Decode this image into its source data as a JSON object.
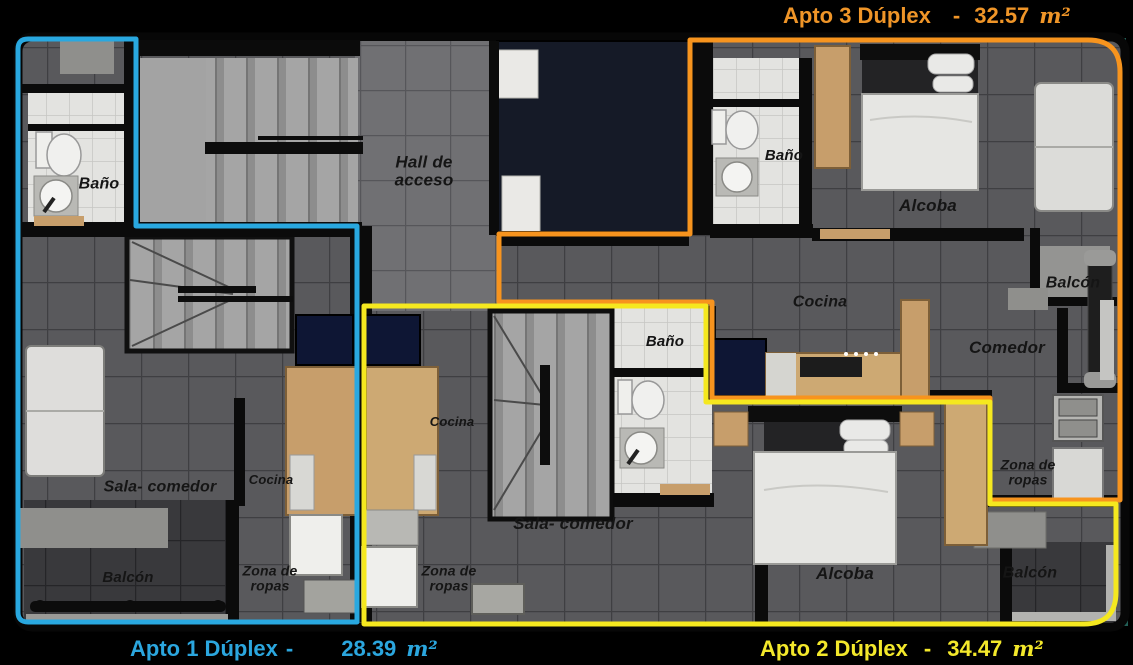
{
  "legend": {
    "apto1": {
      "name": "Apto 1 Dúplex",
      "dash": "-",
      "area": "28.39",
      "unit": "m²"
    },
    "apto2": {
      "name": "Apto 2 Dúplex",
      "dash": "-",
      "area": "34.47",
      "unit": "m²"
    },
    "apto3": {
      "name": "Apto 3 Dúplex",
      "dash": "-",
      "area": "32.57",
      "unit": "m²"
    }
  },
  "colors": {
    "apto1": "#29a8e0",
    "apto2": "#f5e81f",
    "apto3": "#f7941e"
  },
  "rooms": {
    "bano_apto1": "Baño",
    "hall": "Hall de acceso",
    "bano_apto3": "Baño",
    "alcoba_apto3": "Alcoba",
    "balcon_apto3": "Balcón",
    "cocina_apto3": "Cocina",
    "comedor_apto3": "Comedor",
    "bano_apto2": "Baño",
    "cocina_apto2": "Cocina",
    "cocina_apto1": "Cocina",
    "sala_comedor_apto1": "Sala- comedor",
    "sala_comedor_apto2": "Sala- comedor",
    "zona_ropas_apto3": "Zona de ropas",
    "balcon_apto1": "Balcón",
    "zona_ropas_apto1": "Zona de ropas",
    "zona_ropas_apto2": "Zona de ropas",
    "alcoba_apto2": "Alcoba",
    "balcon_apto2": "Balcón"
  }
}
